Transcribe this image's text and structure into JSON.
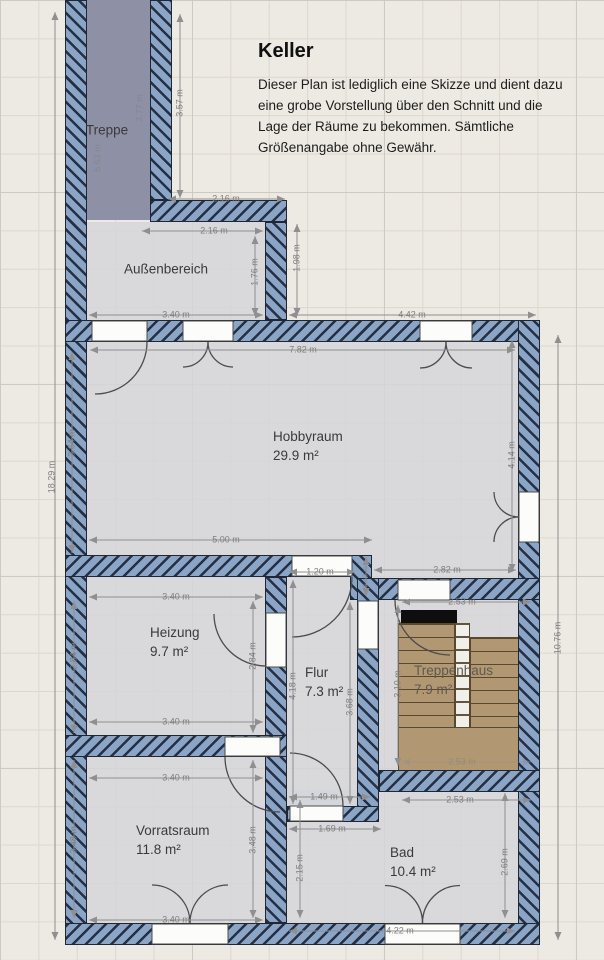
{
  "header": {
    "title": "Keller",
    "disclaimer": "Dieser Plan ist lediglich eine Skizze und dient dazu eine grobe Vorstellung über den Schnitt und die Lage der Räume zu bekommen. Sämtliche Größenangabe ohne Gewähr."
  },
  "colors": {
    "wall": "#8aa5c6",
    "corridor": "#8e90a6",
    "stairs": "#b29872",
    "paper": "#edeae3"
  },
  "room_labels": [
    {
      "id": "treppe",
      "name": "Treppe",
      "area": "",
      "x": 107,
      "y": 131,
      "align": "center"
    },
    {
      "id": "aussenbereich",
      "name": "Außenbereich",
      "area": "",
      "x": 166,
      "y": 270,
      "align": "center"
    },
    {
      "id": "hobbyraum",
      "name": "Hobbyraum",
      "area": "29.9 m²",
      "x": 273,
      "y": 428,
      "align": "left"
    },
    {
      "id": "heizung",
      "name": "Heizung",
      "area": "9.7 m²",
      "x": 150,
      "y": 624,
      "align": "left"
    },
    {
      "id": "flur",
      "name": "Flur",
      "area": "7.3 m²",
      "x": 305,
      "y": 664,
      "align": "left"
    },
    {
      "id": "treppenhaus",
      "name": "Treppenhaus",
      "area": "7.9 m²",
      "x": 414,
      "y": 662,
      "align": "left",
      "wood": true
    },
    {
      "id": "vorratsraum",
      "name": "Vorratsraum",
      "area": "11.8 m²",
      "x": 136,
      "y": 822,
      "align": "left"
    },
    {
      "id": "bad",
      "name": "Bad",
      "area": "10.4 m²",
      "x": 390,
      "y": 844,
      "align": "left"
    }
  ],
  "dimensions": [
    {
      "text": "3.57 m",
      "x": 180,
      "y": 103,
      "rot": 1
    },
    {
      "text": "3.77 m",
      "x": 140,
      "y": 108,
      "rot": 1,
      "faint": 1
    },
    {
      "text": "5.63 m",
      "x": 98,
      "y": 158,
      "rot": 1,
      "faint": 1
    },
    {
      "text": "2.16 m",
      "x": 226,
      "y": 199
    },
    {
      "text": "2.16 m",
      "x": 214,
      "y": 231
    },
    {
      "text": "1.76 m",
      "x": 255,
      "y": 272,
      "rot": 1
    },
    {
      "text": "1.98 m",
      "x": 297,
      "y": 258,
      "rot": 1
    },
    {
      "text": "3.40 m",
      "x": 176,
      "y": 315
    },
    {
      "text": "4.42 m",
      "x": 412,
      "y": 315
    },
    {
      "text": "7.82 m",
      "x": 303,
      "y": 350
    },
    {
      "text": "3.64 m",
      "x": 72,
      "y": 443,
      "rot": 1
    },
    {
      "text": "4.14 m",
      "x": 512,
      "y": 455,
      "rot": 1
    },
    {
      "text": "5.00 m",
      "x": 226,
      "y": 540
    },
    {
      "text": "1.20 m",
      "x": 320,
      "y": 572
    },
    {
      "text": "2.82 m",
      "x": 447,
      "y": 570
    },
    {
      "text": "0.42 m",
      "x": 366,
      "y": 577,
      "rot": 1,
      "tiny": 1,
      "faint": 1
    },
    {
      "text": "3.40 m",
      "x": 176,
      "y": 597
    },
    {
      "text": "2.53 m",
      "x": 462,
      "y": 602
    },
    {
      "text": "2.84 m",
      "x": 74,
      "y": 656,
      "rot": 1
    },
    {
      "text": "2.84 m",
      "x": 253,
      "y": 656,
      "rot": 1
    },
    {
      "text": "4.18 m",
      "x": 293,
      "y": 686,
      "rot": 1
    },
    {
      "text": "3.68 m",
      "x": 350,
      "y": 702,
      "rot": 1
    },
    {
      "text": "3.10 m",
      "x": 398,
      "y": 684,
      "rot": 1
    },
    {
      "text": "10.76 m",
      "x": 558,
      "y": 638,
      "rot": 1
    },
    {
      "text": "18.29 m",
      "x": 52,
      "y": 477,
      "rot": 1
    },
    {
      "text": "3.40 m",
      "x": 176,
      "y": 722
    },
    {
      "text": "3.40 m",
      "x": 176,
      "y": 778
    },
    {
      "text": "2.53 m",
      "x": 462,
      "y": 762,
      "faint": 1
    },
    {
      "text": "2.53 m",
      "x": 460,
      "y": 800
    },
    {
      "text": "1.49 m",
      "x": 324,
      "y": 797
    },
    {
      "text": "1.69 m",
      "x": 332,
      "y": 829
    },
    {
      "text": "3.48 m",
      "x": 74,
      "y": 840,
      "rot": 1
    },
    {
      "text": "3.48 m",
      "x": 253,
      "y": 840,
      "rot": 1
    },
    {
      "text": "2.15 m",
      "x": 300,
      "y": 868,
      "rot": 1
    },
    {
      "text": "2.69 m",
      "x": 505,
      "y": 862,
      "rot": 1
    },
    {
      "text": "3.40 m",
      "x": 176,
      "y": 920
    },
    {
      "text": "4.22 m",
      "x": 400,
      "y": 931
    }
  ]
}
